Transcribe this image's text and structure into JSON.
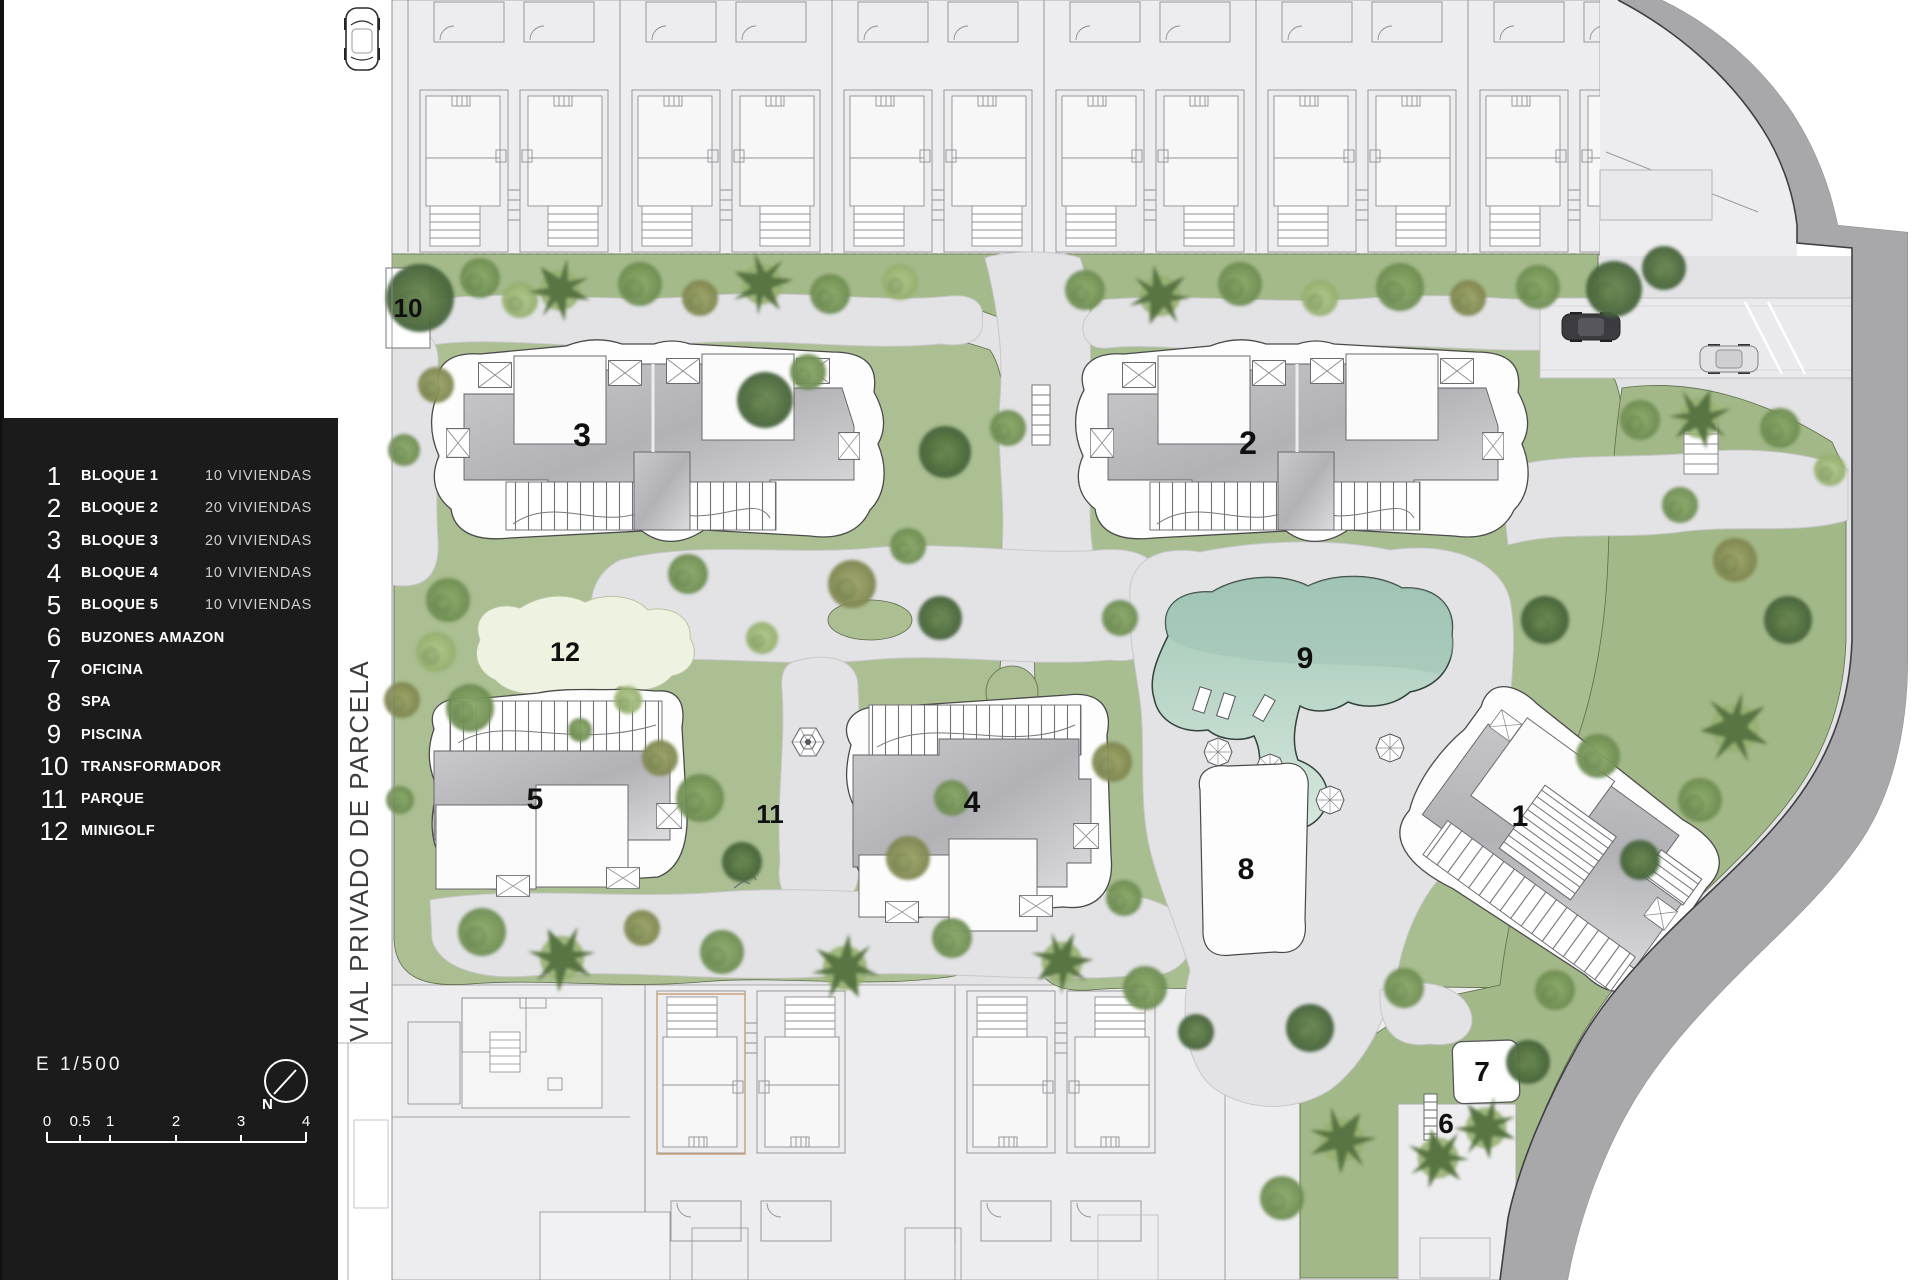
{
  "legend": {
    "items": [
      {
        "num": "1",
        "label": "BLOQUE 1",
        "sub": "10 VIVIENDAS"
      },
      {
        "num": "2",
        "label": "BLOQUE 2",
        "sub": "20 VIVIENDAS"
      },
      {
        "num": "3",
        "label": "BLOQUE 3",
        "sub": "20 VIVIENDAS"
      },
      {
        "num": "4",
        "label": "BLOQUE 4",
        "sub": "10 VIVIENDAS"
      },
      {
        "num": "5",
        "label": "BLOQUE 5",
        "sub": "10 VIVIENDAS"
      },
      {
        "num": "6",
        "label": "BUZONES AMAZON",
        "sub": ""
      },
      {
        "num": "7",
        "label": "OFICINA",
        "sub": ""
      },
      {
        "num": "8",
        "label": "SPA",
        "sub": ""
      },
      {
        "num": "9",
        "label": "PISCINA",
        "sub": ""
      },
      {
        "num": "10",
        "label": "TRANSFORMADOR",
        "sub": ""
      },
      {
        "num": "11",
        "label": "PARQUE",
        "sub": ""
      },
      {
        "num": "12",
        "label": "MINIGOLF",
        "sub": ""
      }
    ],
    "scale_label": "E 1/500",
    "north_label": "N",
    "scalebar_ticks": [
      {
        "label": "0",
        "x": 41
      },
      {
        "label": "0.5",
        "x": 74
      },
      {
        "label": "1",
        "x": 104
      },
      {
        "label": "2",
        "x": 170
      },
      {
        "label": "3",
        "x": 235
      },
      {
        "label": "4",
        "x": 300
      }
    ]
  },
  "road_label": "VIAL PRIVADO DE PARCELA",
  "plan": {
    "markers": [
      {
        "label": "1",
        "x": 1520,
        "y": 826,
        "size": 30
      },
      {
        "label": "2",
        "x": 1248,
        "y": 454,
        "size": 32
      },
      {
        "label": "3",
        "x": 582,
        "y": 446,
        "size": 32
      },
      {
        "label": "4",
        "x": 972,
        "y": 812,
        "size": 30
      },
      {
        "label": "5",
        "x": 535,
        "y": 809,
        "size": 30
      },
      {
        "label": "6",
        "x": 1446,
        "y": 1133,
        "size": 28
      },
      {
        "label": "7",
        "x": 1482,
        "y": 1081,
        "size": 28
      },
      {
        "label": "8",
        "x": 1246,
        "y": 879,
        "size": 30
      },
      {
        "label": "9",
        "x": 1305,
        "y": 668,
        "size": 30
      },
      {
        "label": "10",
        "x": 408,
        "y": 317,
        "size": 26
      },
      {
        "label": "11",
        "x": 770,
        "y": 823,
        "size": 26
      },
      {
        "label": "12",
        "x": 565,
        "y": 661,
        "size": 27
      }
    ]
  },
  "colors": {
    "panel": "#1b1b1b",
    "grass": "#a9bd8f",
    "hardscape": "#e3e3e6",
    "pool": "#aecfc0",
    "road": "#a8a8ab",
    "minigolf": "#eef2e0"
  }
}
